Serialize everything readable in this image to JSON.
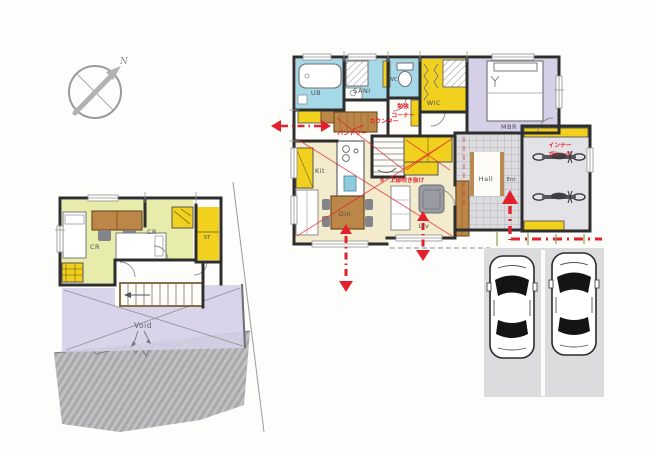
{
  "compass": {
    "north_label": "N"
  },
  "floor2": {
    "room_cr1": "CR",
    "room_cr2": "CR",
    "room_st": "ST",
    "void_label": "Void"
  },
  "floor1": {
    "room_ub": "UB",
    "room_sani": "SANI",
    "room_wc": "WC",
    "room_wic": "WIC",
    "room_mbr": "MBR",
    "room_kit": "Kit",
    "room_din": "Din",
    "room_liv": "Liv",
    "room_hall": "Hall",
    "room_ent": "Ent"
  },
  "annotations": {
    "study_corner_line1": "勉強",
    "study_corner_line2": "コーナー",
    "counter": "カウンター",
    "pantry": "パントリー",
    "void_above": "上部吹き抜け",
    "inner_garage_line1": "インナー",
    "inner_garage_line2": "ガレージ"
  },
  "colors": {
    "annotation_red": "#e3202e",
    "room_yellow": "#f2d11e",
    "room_blue": "#a6d9e8",
    "room_lavender": "#d6cfe8",
    "room_green": "#e7ecab",
    "ldk_floor": "#f2ebcc",
    "wood": "#bc8648",
    "wall": "#2e2e2e"
  }
}
